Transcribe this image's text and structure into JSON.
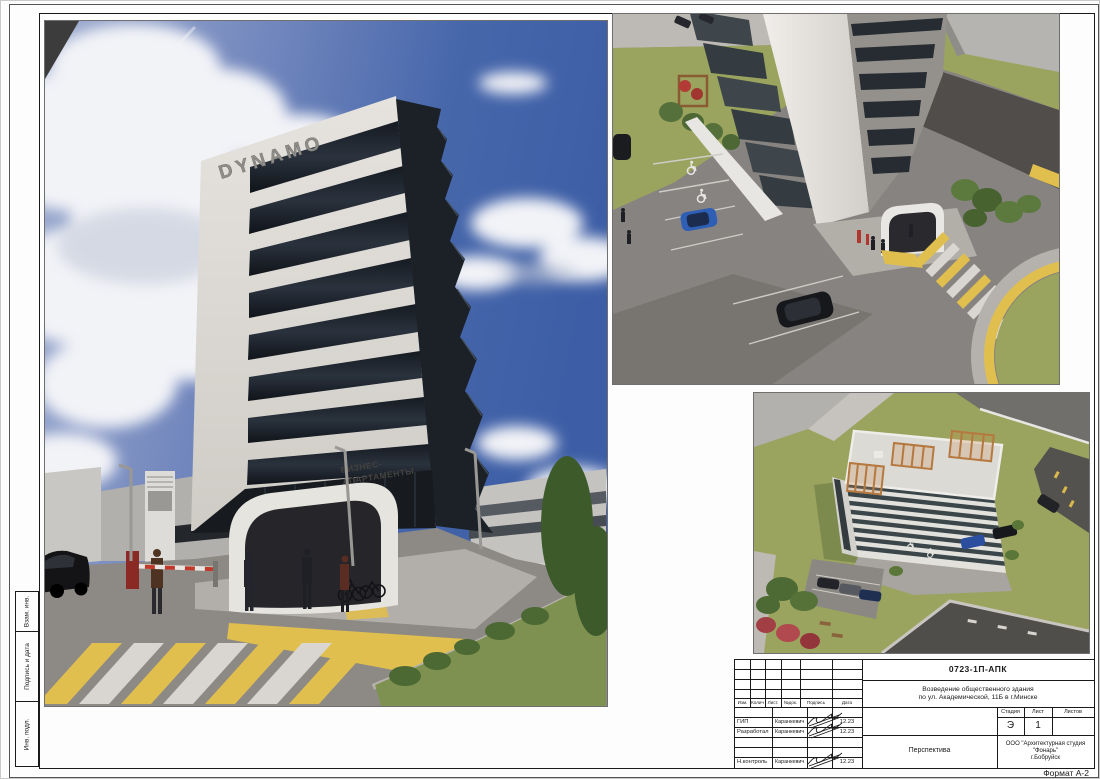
{
  "sheet": {
    "format_label": "Формат А-2",
    "side_labels": {
      "top": "Взам. инв.",
      "middle": "Подпись и дата",
      "bottom": "Инв. подл."
    }
  },
  "title_block": {
    "doc_code": "0723-1П-АПК",
    "project_line1": "Возведение общественного здания",
    "project_line2": "по ул. Академической, 11Б в г.Минске",
    "change_columns": [
      "Изм.",
      "Колич",
      "Лист.",
      "№док.",
      "Подпись",
      "Дата"
    ],
    "rows": [
      {
        "role": "",
        "name": "",
        "date": ""
      },
      {
        "role": "ГИП",
        "name": "Каранкевич",
        "date": "12.23"
      },
      {
        "role": "Разработал",
        "name": "Каранкевич",
        "date": "12.23"
      },
      {
        "role": "",
        "name": "",
        "date": ""
      },
      {
        "role": "",
        "name": "",
        "date": ""
      },
      {
        "role": "Н.контроль",
        "name": "Каранкевич",
        "date": "12.23"
      }
    ],
    "stage_columns": [
      "Стадия",
      "Лист",
      "Листов"
    ],
    "stage_value": "Э",
    "sheet_value": "1",
    "sheets_total_value": "",
    "view_title": "Перспектива",
    "company_line1": "ООО \"Архитектурная студия \"Фонарь\"",
    "company_line2": "г.Бобруйск"
  },
  "renders": {
    "main": {
      "sign_text": "DYNAMO",
      "wall_text_line1": "БИЗНЕС-",
      "wall_text_line2": "АПАРТАМЕНТЫ"
    }
  },
  "colors": {
    "sky_blue": "#3d5ea6",
    "cloud_white": "#f2f3f7",
    "building_white": "#dcd9d4",
    "glazing_dark": "#20262e",
    "accent_yellow": "#e0bf4e",
    "lawn_green": "#7e9150",
    "aerial_lawn_green": "#9aa45e",
    "asphalt_gray": "#8d8a86",
    "signage_gray": "#8f8d89"
  }
}
